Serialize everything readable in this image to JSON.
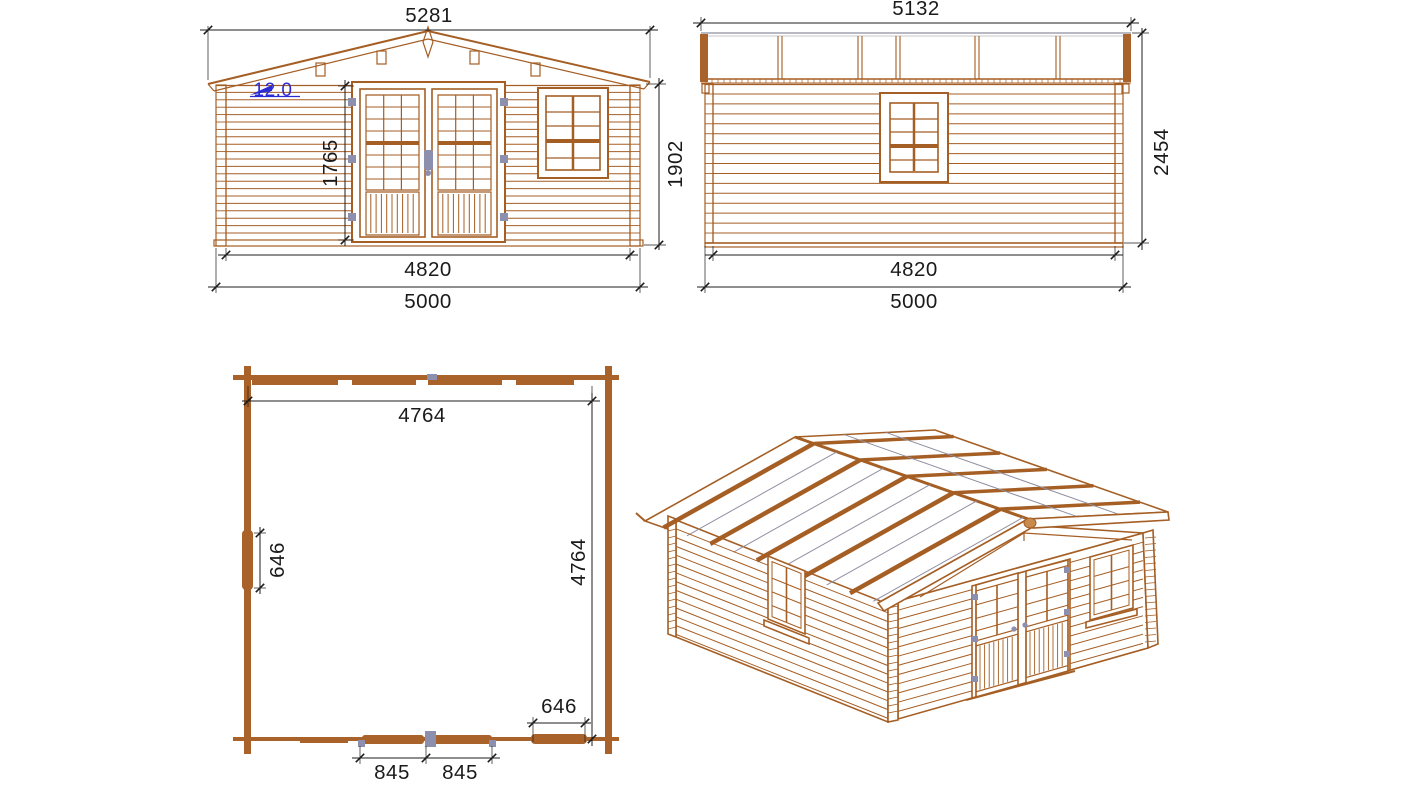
{
  "colors": {
    "wood": "#a55e24",
    "wood_fill": "#a9622a",
    "dimension": "#1c1c1c",
    "annotation_blue": "#2b2bd4",
    "hardware_gray": "#8d8fae",
    "roof_gray": "#8f8fa0",
    "background": "#ffffff"
  },
  "views": {
    "front": {
      "dims": {
        "overall_width": "5281",
        "roof_pitch": "12.0",
        "door_height": "1765",
        "eaves_height": "1902",
        "log_length": "4820",
        "base_width": "5000"
      }
    },
    "side": {
      "dims": {
        "roof_length": "5132",
        "ridge_height": "2454",
        "log_length": "4820",
        "base_depth": "5000"
      }
    },
    "plan": {
      "dims": {
        "inner_width": "4764",
        "inner_depth": "4764",
        "side_window_width": "646",
        "front_window_width": "646",
        "door_leaf_left": "845",
        "door_leaf_right": "845"
      }
    }
  }
}
